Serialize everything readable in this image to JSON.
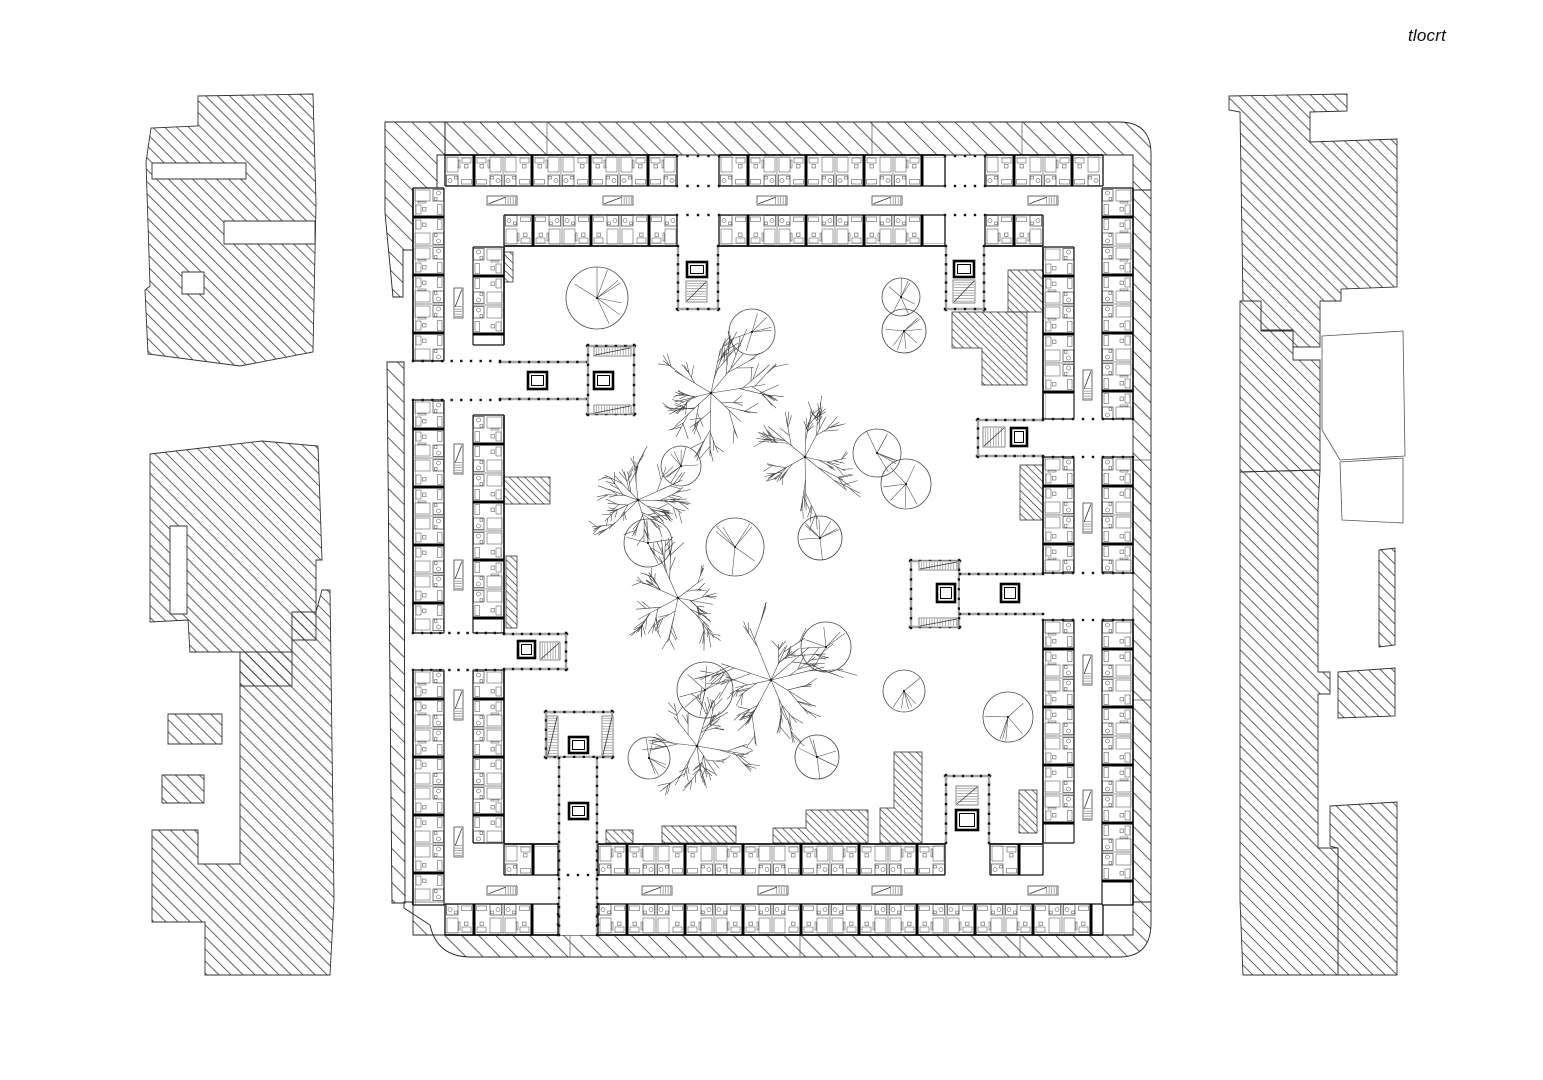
{
  "title": {
    "label": "tlocrt"
  },
  "colors": {
    "bg": "#ffffff",
    "ink": "#1b1b1b",
    "wall": "#111111",
    "soft": "#555555",
    "gray_wall": "#a5a5a5",
    "hatch": "#333333",
    "furniture": "#555555"
  },
  "canvas": {
    "w": 1543,
    "h": 1080
  },
  "room": {
    "unit": 58,
    "half": 29,
    "depth": 31
  },
  "ring_segments": [
    {
      "axis": "h",
      "w": 155,
      "dir": 1,
      "spans": [
        [
          445,
          677
        ],
        [
          719,
          945
        ],
        [
          985,
          1103
        ]
      ]
    },
    {
      "axis": "h",
      "w": 246,
      "dir": -1,
      "spans": [
        [
          504,
          677
        ],
        [
          719,
          945
        ],
        [
          985,
          1043
        ]
      ]
    },
    {
      "axis": "h",
      "w": 935,
      "dir": -1,
      "spans": [
        [
          445,
          558
        ],
        [
          598,
          1103
        ]
      ]
    },
    {
      "axis": "h",
      "w": 844,
      "dir": 1,
      "spans": [
        [
          504,
          558
        ],
        [
          598,
          945
        ],
        [
          990,
          1043
        ]
      ]
    },
    {
      "axis": "v",
      "w": 413,
      "dir": 1,
      "spans": [
        [
          188,
          361
        ],
        [
          400,
          633
        ],
        [
          670,
          905
        ]
      ]
    },
    {
      "axis": "v",
      "w": 504,
      "dir": -1,
      "spans": [
        [
          247,
          345
        ],
        [
          415,
          633
        ],
        [
          670,
          843
        ]
      ]
    },
    {
      "axis": "v",
      "w": 1133,
      "dir": -1,
      "spans": [
        [
          188,
          419
        ],
        [
          457,
          573
        ],
        [
          620,
          905
        ]
      ]
    },
    {
      "axis": "v",
      "w": 1043,
      "dir": 1,
      "spans": [
        [
          247,
          419
        ],
        [
          457,
          573
        ],
        [
          620,
          843
        ]
      ]
    }
  ],
  "band_paths": [
    "M445,122 L1119,122 Q1151,122 1151,154 L1151,190 L1133,190 L1133,155 L445,155 Z",
    "M1133,190 L1151,190 L1151,902 L1133,902 Z",
    "M404,902 L413,902 L413,935 L1133,935 L1133,902 L1151,902 L1151,923 Q1151,957 1119,957 L471,957 Q437,957 430,925 L404,908 Z",
    "M385,122 L445,122 L445,155 L437,155 L437,188 L413,188 L413,250 L403,250 L403,297 L393,297 L385,213 Z",
    "M387,362 L404,362 L405,903 L392,903 Z"
  ],
  "band_joints": [
    [
      547,
      122,
      547,
      155
    ],
    [
      872,
      122,
      872,
      155
    ],
    [
      1022,
      122,
      1022,
      155
    ],
    [
      570,
      935,
      570,
      957
    ],
    [
      800,
      935,
      800,
      957
    ],
    [
      1020,
      935,
      1020,
      957
    ],
    [
      1133,
      460,
      1151,
      460
    ],
    [
      1133,
      700,
      1151,
      700
    ]
  ],
  "context_hatched": [
    "M198,96 L313,94 L316,203 L313,352 L240,366 L148,354 L145,290 L150,286 L146,162 L151,128 L198,126 Z M152,163 L246,163 L246,179 L152,179 Z M224,221 L315,221 L315,244 L224,244 Z M182,272 L204,272 L204,294 L182,294 Z",
    "M150,454 L262,441 L318,446 L322,560 L316,560 L316,640 L292,640 L292,686 L240,686 L240,652 L190,652 L188,620 L150,622 Z M170,526 L187,526 L187,614 L170,614 Z",
    "M240,652 L292,652 L292,612 L316,612 L322,590 L330,590 L334,900 L330,975 L205,975 L205,922 L152,922 L152,830 L198,830 L198,864 L240,864 Z",
    "M168,714 L222,714 L222,744 L168,744 Z",
    "M162,775 L204,775 L204,803 L162,803 Z",
    "M1229,96 L1347,94 L1347,111 L1310,112 L1310,142 L1397,139 L1397,287 L1341,289 L1341,301 L1320,301 L1320,347 L1293,347 L1293,330 L1261,330 L1261,301 L1243,301 L1240,112 L1229,110 Z",
    "M1240,301 L1261,301 L1261,331 L1293,331 L1293,360 L1320,360 L1320,470 L1240,472 Z",
    "M1240,472 L1320,470 L1318,508 L1318,672 L1330,672 L1330,694 L1318,694 L1318,848 L1338,848 L1338,975 L1243,975 L1240,900 Z",
    "M1338,672 L1395,668 L1395,716 L1338,718 Z",
    "M1379,550 L1395,548 L1395,645 L1379,647 Z",
    "M1330,806 L1397,802 L1397,975 L1338,975 L1338,848 L1330,846 Z"
  ],
  "context_outline": [
    "M1322,336 L1403,331 L1405,456 L1340,460 L1322,430 Z",
    "M1340,462 L1403,458 L1403,523 L1342,520 Z"
  ],
  "courtyard_patches": [
    "M504,252 L513,252 L513,282 L504,282 Z",
    "M1008,270 L1043,270 L1043,312 L1008,312 Z",
    "M952,312 L1027,312 L1027,385 L982,385 L982,348 L952,348 Z",
    "M1020,465 L1043,465 L1043,520 L1020,520 Z",
    "M504,477 L550,477 L550,504 L504,504 Z",
    "M506,556 L517,556 L517,628 L506,628 Z",
    "M606,830 L633,830 L633,843 L606,843 Z",
    "M662,826 L736,826 L736,843 L662,843 Z",
    "M773,828 L806,828 L806,810 L868,810 L868,843 L773,843 Z",
    "M894,752 L922,752 L922,843 L880,843 L880,808 L894,808 Z",
    "M1019,790 L1037,790 L1037,833 L1019,833 Z"
  ],
  "wings": [
    {
      "x": 677,
      "y": 246,
      "w": 42,
      "h": 64,
      "sides": [
        "left",
        "right",
        "bottom"
      ]
    },
    {
      "x": 945,
      "y": 246,
      "w": 40,
      "h": 64,
      "sides": [
        "left",
        "right",
        "bottom"
      ]
    },
    {
      "x": 500,
      "y": 361,
      "w": 87,
      "h": 39,
      "sides": [
        "top",
        "bottom"
      ]
    },
    {
      "x": 587,
      "y": 345,
      "w": 48,
      "h": 70,
      "sides": [
        "top",
        "right",
        "bottom",
        "left"
      ]
    },
    {
      "x": 504,
      "y": 633,
      "w": 63,
      "h": 37,
      "sides": [
        "top",
        "bottom",
        "right"
      ]
    },
    {
      "x": 545,
      "y": 711,
      "w": 68,
      "h": 47,
      "sides": [
        "top",
        "right",
        "bottom",
        "left"
      ]
    },
    {
      "x": 558,
      "y": 758,
      "w": 40,
      "h": 177,
      "sides": [
        "left",
        "right"
      ]
    },
    {
      "x": 977,
      "y": 419,
      "w": 66,
      "h": 38,
      "sides": [
        "top",
        "bottom",
        "left"
      ]
    },
    {
      "x": 910,
      "y": 560,
      "w": 50,
      "h": 68,
      "sides": [
        "top",
        "right",
        "bottom",
        "left"
      ]
    },
    {
      "x": 960,
      "y": 573,
      "w": 83,
      "h": 42,
      "sides": [
        "top",
        "bottom"
      ]
    },
    {
      "x": 945,
      "y": 775,
      "w": 45,
      "h": 68,
      "sides": [
        "top",
        "left",
        "right"
      ]
    }
  ],
  "elevators": [
    [
      687,
      262,
      20,
      15
    ],
    [
      954,
      261,
      20,
      16
    ],
    [
      528,
      372,
      19,
      17
    ],
    [
      594,
      372,
      19,
      17
    ],
    [
      518,
      641,
      17,
      17
    ],
    [
      569,
      737,
      19,
      16
    ],
    [
      569,
      803,
      19,
      16
    ],
    [
      1011,
      428,
      16,
      18
    ],
    [
      937,
      584,
      18,
      18
    ],
    [
      1001,
      584,
      18,
      18
    ],
    [
      956,
      810,
      22,
      20
    ]
  ],
  "stairs": [
    [
      686,
      281,
      21,
      21,
      "v"
    ],
    [
      953,
      280,
      22,
      23,
      "v"
    ],
    [
      594,
      347,
      37,
      9,
      "h"
    ],
    [
      594,
      405,
      37,
      9,
      "h"
    ],
    [
      540,
      642,
      20,
      18,
      "h"
    ],
    [
      547,
      716,
      11,
      40,
      "v"
    ],
    [
      602,
      716,
      11,
      40,
      "v"
    ],
    [
      983,
      427,
      22,
      20,
      "h"
    ],
    [
      919,
      561,
      39,
      9,
      "h"
    ],
    [
      919,
      618,
      39,
      9,
      "h"
    ],
    [
      956,
      786,
      22,
      19,
      "v"
    ]
  ],
  "corridor_stairs": [
    [
      487,
      196,
      30,
      9,
      0
    ],
    [
      603,
      196,
      30,
      9,
      0
    ],
    [
      757,
      196,
      30,
      9,
      0
    ],
    [
      872,
      196,
      30,
      9,
      0
    ],
    [
      1028,
      196,
      30,
      9,
      0
    ],
    [
      487,
      886,
      30,
      9,
      0
    ],
    [
      642,
      886,
      30,
      9,
      0
    ],
    [
      758,
      886,
      30,
      9,
      0
    ],
    [
      872,
      886,
      30,
      9,
      0
    ],
    [
      1028,
      886,
      30,
      9,
      0
    ],
    [
      454,
      288,
      9,
      30,
      1
    ],
    [
      454,
      444,
      9,
      30,
      1
    ],
    [
      454,
      560,
      9,
      30,
      1
    ],
    [
      454,
      690,
      9,
      30,
      1
    ],
    [
      454,
      827,
      9,
      30,
      1
    ],
    [
      1083,
      370,
      9,
      30,
      1
    ],
    [
      1083,
      503,
      9,
      30,
      1
    ],
    [
      1083,
      655,
      9,
      30,
      1
    ],
    [
      1083,
      790,
      9,
      30,
      1
    ]
  ],
  "dotlines": [
    [
      677,
      156,
      719,
      156
    ],
    [
      677,
      186,
      719,
      186
    ],
    [
      677,
      215,
      719,
      215
    ],
    [
      945,
      156,
      985,
      156
    ],
    [
      945,
      186,
      985,
      186
    ],
    [
      945,
      215,
      985,
      215
    ],
    [
      413,
      361,
      500,
      361
    ],
    [
      413,
      400,
      500,
      400
    ],
    [
      413,
      633,
      504,
      633
    ],
    [
      413,
      670,
      504,
      670
    ],
    [
      1043,
      419,
      1133,
      419
    ],
    [
      1043,
      457,
      1133,
      457
    ],
    [
      1043,
      573,
      1133,
      573
    ],
    [
      1043,
      620,
      1133,
      620
    ],
    [
      558,
      904,
      558,
      935
    ],
    [
      598,
      904,
      598,
      935
    ],
    [
      558,
      875,
      598,
      875
    ]
  ],
  "trees": {
    "round": [
      [
        597,
        298,
        31
      ],
      [
        752,
        332,
        23
      ],
      [
        901,
        297,
        19
      ],
      [
        904,
        331,
        22
      ],
      [
        681,
        466,
        20
      ],
      [
        877,
        453,
        24
      ],
      [
        906,
        484,
        25
      ],
      [
        735,
        547,
        29
      ],
      [
        820,
        538,
        22
      ],
      [
        648,
        543,
        24
      ],
      [
        705,
        690,
        28
      ],
      [
        826,
        647,
        25
      ],
      [
        649,
        758,
        21
      ],
      [
        817,
        757,
        22
      ],
      [
        904,
        691,
        21
      ],
      [
        1008,
        717,
        25
      ]
    ],
    "branched": [
      [
        711,
        393,
        54
      ],
      [
        805,
        457,
        52
      ],
      [
        638,
        500,
        47
      ],
      [
        678,
        598,
        45
      ],
      [
        771,
        680,
        54
      ],
      [
        697,
        746,
        48
      ]
    ]
  }
}
